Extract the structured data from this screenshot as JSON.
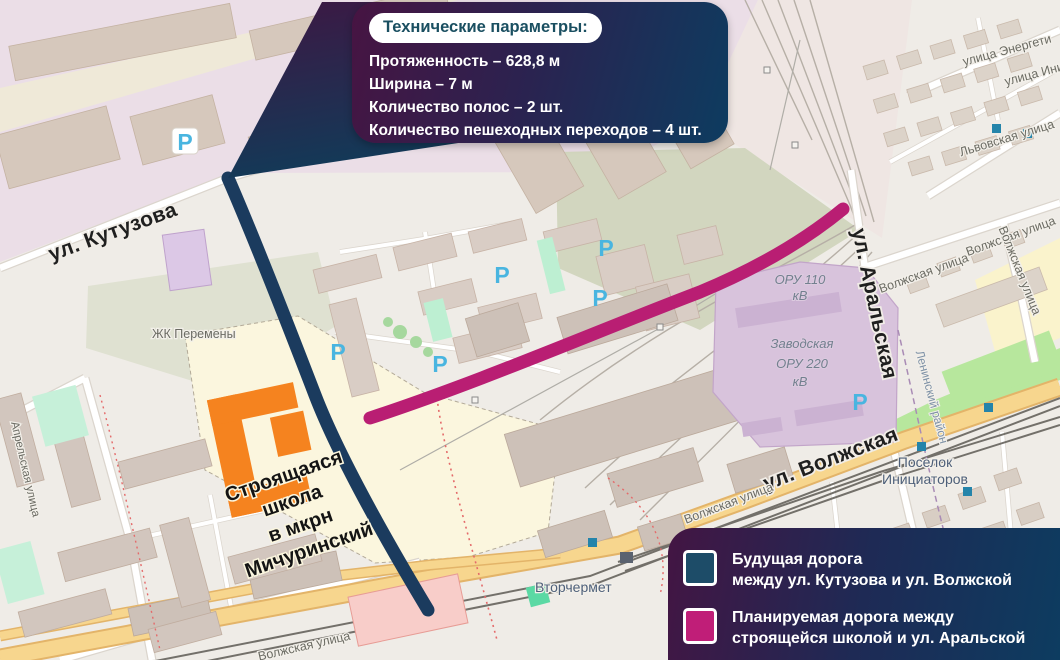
{
  "callout": {
    "title": "Технические параметры:",
    "lines": {
      "l1": "Протяженность – 628,8 м",
      "l2": "Ширина – 7 м",
      "l3": "Количество полос – 2 шт.",
      "l4": "Количество пешеходных переходов – 4 шт."
    }
  },
  "legend": {
    "items": [
      {
        "color": "#1D4C68",
        "line1": "Будущая дорога",
        "line2": "между ул. Кутузова и ул. Волжской"
      },
      {
        "color": "#C01E78",
        "line1": "Планируемая дорога между",
        "line2": "строящейся школой и ул. Аральской"
      }
    ]
  },
  "map": {
    "labels": {
      "kutuzova": "ул. Кутузова",
      "zhk_peremeny": "ЖК Перемены",
      "school_line1": "Строящаяся",
      "school_line2": "школа",
      "school_line3": "в мкрн",
      "school_line4": "Мичуринский",
      "aprelskaya": "Апрельская улица",
      "vtorchermet": "Вторчермет",
      "volzhskaya_big": "ул. Волжская",
      "volzhskaya_small": "Волжская улица",
      "aralskaya": "ул. Аральская",
      "lvovskaya": "Львовская улица",
      "energetikov": "улица Энергети",
      "initsiativnaya": "улица Иници",
      "oru110_line1": "ОРУ 110",
      "oru110_line2": "кВ",
      "zavodskaya_line1": "Заводская",
      "zavodskaya_line2": "ОРУ 220",
      "zavodskaya_line3": "кВ",
      "leninsky": "Ленинский район",
      "poselok_line1": "Поселок",
      "poselok_line2": "Инициаторов",
      "parking": "P"
    },
    "colors": {
      "future_road": "#1B3B5E",
      "planned_road": "#B91E73",
      "school_building": "#F5831F",
      "main_road_fill": "#F7D68E"
    }
  }
}
